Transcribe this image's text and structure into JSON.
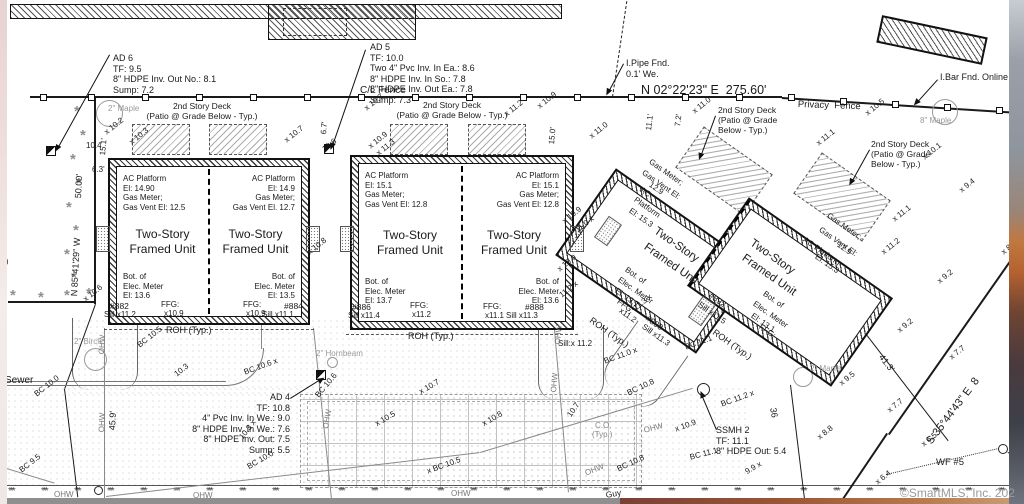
{
  "meta": {
    "watermark": "©SmartMLS, Inc. 202"
  },
  "annotations": {
    "ad6": [
      "AD 6",
      "TF: 9.5",
      "8\" HDPE Inv. Out No.: 8.1",
      "Sump: 7.2"
    ],
    "ad5": [
      "AD 5",
      "TF: 10.0",
      "Two 4\" Pvc Inv. In Ea.: 8.6",
      "8\" HDPE Inv. In So.: 7.8",
      "8\" HDPE Inv. Out Ea.: 7.8",
      "Sump: 7.3"
    ],
    "ad4": [
      "AD 4",
      "TF: 10.8",
      "4\" Pvc Inv. In We.: 9.0",
      "8\" HDPE Inv. In We.: 7.6",
      "8\" HDPE Inv. Out: 7.5",
      "Sump: 5.5"
    ],
    "ssmh2": [
      "SSMH 2",
      "TF: 11.1",
      "8\" HDPE Out: 5.4"
    ],
    "ipipe": [
      "I.Pipe Fnd.",
      "0.1' We."
    ],
    "ibar": [
      "I.Bar Fnd. Online"
    ],
    "deck_ab": [
      "2nd Story Deck",
      "(Patio @ Grade Below - Typ.)"
    ],
    "deck_cd": [
      "2nd Story Deck",
      "(Patio @ Grade",
      "Below - Typ.)"
    ]
  },
  "buildings": {
    "b1u1": {
      "ac": [
        "AC Platform",
        "El: 14.90",
        "Gas Meter;",
        "Gas Vent El: 12.5"
      ],
      "name": [
        "Two-Story",
        "Framed Unit"
      ],
      "elec": [
        "Bot. of",
        "Elec. Meter",
        "El: 13.6"
      ]
    },
    "b1u2": {
      "ac": [
        "AC Platform",
        "El: 14.9",
        "Gas Meter;",
        "Gas Vent El. 12.7"
      ],
      "name": [
        "Two-Story",
        "Framed Unit"
      ],
      "elec": [
        "Bot. of",
        "Elec. Meter",
        "El: 13.5"
      ]
    },
    "b2u1": {
      "ac": [
        "AC Platform",
        "El: 15.1",
        "Gas Meter;",
        "Gas Vent El: 12.8"
      ],
      "name": [
        "Two-Story",
        "Framed Unit"
      ],
      "elec": [
        "Bot. of",
        "Elec. Meter",
        "El: 13.7"
      ]
    },
    "b2u2": {
      "ac": [
        "AC Platform",
        "El: 15.1",
        "Gas Meter;",
        "Gas Vent El: 12.8"
      ],
      "name": [
        "Two-Story",
        "Framed Unit"
      ],
      "elec": [
        "Bot. of",
        "Elec. Meter",
        "El: 13.6"
      ]
    }
  },
  "labels": [
    {
      "t": "N 02°22'23\" E  275.60'",
      "x": 641,
      "y": 84,
      "s": 12.5,
      "n": "bearing-north"
    },
    {
      "t": "C/L Fence",
      "x": 360,
      "y": 86,
      "s": 10,
      "n": "cl-fence-label"
    },
    {
      "t": "Privacy  Fence",
      "x": 798,
      "y": 100,
      "s": 9.5,
      "r": 2,
      "n": "privacy-fence-label"
    },
    {
      "t": "N 85°41'29\" W",
      "x": 70,
      "y": 296,
      "r": -87,
      "s": 9,
      "n": "bearing-west"
    },
    {
      "t": "S 35°44'43\" E  8",
      "x": 925,
      "y": 440,
      "r": -53,
      "s": 11,
      "n": "bearing-southeast"
    },
    {
      "t": "50.00'",
      "x": 74,
      "y": 198,
      "r": -87,
      "s": 9
    },
    {
      "t": "15.1'",
      "x": 99,
      "y": 155,
      "r": -85
    },
    {
      "t": "6.3'",
      "x": 92,
      "y": 166
    },
    {
      "t": "45.9'",
      "x": 108,
      "y": 430,
      "r": -87,
      "s": 9
    },
    {
      "t": "6.7'",
      "x": 320,
      "y": 134,
      "r": -85
    },
    {
      "t": "15.0'",
      "x": 548,
      "y": 144,
      "r": -85
    },
    {
      "t": "11.1'",
      "x": 645,
      "y": 130,
      "r": -83
    },
    {
      "t": "7.2'",
      "x": 674,
      "y": 126,
      "r": -83
    },
    {
      "t": "41.3'",
      "x": 884,
      "y": 353,
      "r": 52,
      "s": 9
    },
    {
      "t": "36",
      "x": 777,
      "y": 407,
      "r": 80,
      "s": 9
    },
    {
      "t": "2\" Maple",
      "x": 108,
      "y": 105,
      "c": "#999",
      "n": "tree-label"
    },
    {
      "t": "8\" Maple",
      "x": 920,
      "y": 117,
      "c": "#999",
      "n": "tree-label"
    },
    {
      "t": "2\" Birch",
      "x": 74,
      "y": 338,
      "c": "#999",
      "n": "tree-label"
    },
    {
      "t": "2\" Hornbeam",
      "x": 316,
      "y": 350,
      "c": "#999",
      "n": "tree-label"
    },
    {
      "t": "2\" Maple",
      "x": 810,
      "y": 365,
      "c": "#999",
      "n": "tree-label"
    },
    {
      "t": "Sewer",
      "x": 5,
      "y": 376,
      "s": 10,
      "n": "sewer-label"
    },
    {
      "t": "Guy",
      "x": 605,
      "y": 491,
      "r": -10,
      "s": 8.5
    },
    {
      "t": "WF #5",
      "x": 936,
      "y": 458,
      "s": 9.5,
      "n": "wetland-flag-label"
    },
    {
      "t": "(Typ.)",
      "x": -12,
      "y": 258
    },
    {
      "t": "C.O.",
      "x": 595,
      "y": 422,
      "c": "#888"
    },
    {
      "t": "(Typ.)",
      "x": 592,
      "y": 431,
      "c": "#888"
    },
    {
      "t": "x 10.2",
      "x": 103,
      "y": 130,
      "r": -38
    },
    {
      "t": "10.4",
      "x": 86,
      "y": 142
    },
    {
      "t": "x 10.3",
      "x": 128,
      "y": 140,
      "r": -38
    },
    {
      "t": "x 10.7",
      "x": 363,
      "y": 106,
      "r": -38
    },
    {
      "t": "x 10.9",
      "x": 536,
      "y": 104,
      "r": -38
    },
    {
      "t": "x 11.2",
      "x": 503,
      "y": 112,
      "r": -38
    },
    {
      "t": "x 10.7",
      "x": 283,
      "y": 138,
      "r": -38
    },
    {
      "t": "10.6",
      "x": 321,
      "y": 147,
      "r": -38
    },
    {
      "t": "x 10.9",
      "x": 367,
      "y": 144,
      "r": -38
    },
    {
      "t": "x 11.3",
      "x": 375,
      "y": 151,
      "r": -38
    },
    {
      "t": "x 10.8",
      "x": 306,
      "y": 250,
      "r": -38
    },
    {
      "t": "x 10.9",
      "x": 561,
      "y": 219,
      "r": -38
    },
    {
      "t": "x 10.9",
      "x": 556,
      "y": 267,
      "r": -38
    },
    {
      "t": "11.2 x",
      "x": 558,
      "y": 293,
      "r": -38
    },
    {
      "t": "11.0 x",
      "x": 574,
      "y": 228,
      "r": -38
    },
    {
      "t": "x 11.0",
      "x": 588,
      "y": 134,
      "r": -38
    },
    {
      "t": "x 11.0",
      "x": 691,
      "y": 109,
      "r": -38
    },
    {
      "t": "x 10.5",
      "x": 864,
      "y": 111,
      "r": -38
    },
    {
      "t": "x 11.1",
      "x": 815,
      "y": 141,
      "r": -38
    },
    {
      "t": "x 10.1",
      "x": 921,
      "y": 155,
      "r": -38
    },
    {
      "t": "x 9.4",
      "x": 958,
      "y": 188,
      "r": -38
    },
    {
      "t": "x 11.1",
      "x": 891,
      "y": 217,
      "r": -38
    },
    {
      "t": "x 11.2",
      "x": 880,
      "y": 250,
      "r": -38
    },
    {
      "t": "x 9.2",
      "x": 936,
      "y": 279,
      "r": -38
    },
    {
      "t": "x 8",
      "x": 1000,
      "y": 250,
      "r": -38
    },
    {
      "t": "x 9.2",
      "x": 896,
      "y": 328,
      "r": -38
    },
    {
      "t": "x 7.7",
      "x": 948,
      "y": 355,
      "r": -38
    },
    {
      "t": "x 7.7",
      "x": 886,
      "y": 408,
      "r": -38
    },
    {
      "t": "x 6.5",
      "x": 920,
      "y": 442,
      "r": -38
    },
    {
      "t": "x 6.4",
      "x": 874,
      "y": 480,
      "r": -38
    },
    {
      "t": "x 8.8",
      "x": 816,
      "y": 435,
      "r": -38
    },
    {
      "t": "9.9 x",
      "x": 744,
      "y": 469,
      "r": -30
    },
    {
      "t": "x 9.5",
      "x": 838,
      "y": 381,
      "r": -38
    },
    {
      "t": "11.3 x",
      "x": 632,
      "y": 306,
      "r": -38
    },
    {
      "t": "x 10.6",
      "x": 82,
      "y": 297,
      "r": -38
    },
    {
      "t": "BC 10.5",
      "x": 136,
      "y": 343,
      "r": -38
    },
    {
      "t": "10.3",
      "x": 173,
      "y": 372,
      "r": -38
    },
    {
      "t": "BC 10.6 x",
      "x": 243,
      "y": 369,
      "r": -20
    },
    {
      "t": "BC 10.6",
      "x": 314,
      "y": 394,
      "r": -50
    },
    {
      "t": "x 10.7",
      "x": 418,
      "y": 389,
      "r": -30
    },
    {
      "t": "x 10.5",
      "x": 374,
      "y": 421,
      "r": -30
    },
    {
      "t": "x 10.8",
      "x": 481,
      "y": 421,
      "r": -30
    },
    {
      "t": "x BC 10.5",
      "x": 426,
      "y": 468,
      "r": -20
    },
    {
      "t": "BC 10.0",
      "x": 33,
      "y": 392,
      "r": -38
    },
    {
      "t": "BC 10.0",
      "x": 246,
      "y": 464,
      "r": -30
    },
    {
      "t": "BC 9.5",
      "x": 18,
      "y": 468,
      "r": -38
    },
    {
      "t": "10.3 x",
      "x": 238,
      "y": 436,
      "r": -52
    },
    {
      "t": "10.7",
      "x": 566,
      "y": 414,
      "r": -55
    },
    {
      "t": "Sill:x 11.2",
      "x": 558,
      "y": 340
    },
    {
      "t": "BC 11.0 x",
      "x": 603,
      "y": 358,
      "r": -20
    },
    {
      "t": "BC 10.8",
      "x": 626,
      "y": 390,
      "r": -25
    },
    {
      "t": "BC 11.1",
      "x": 684,
      "y": 344,
      "r": -20
    },
    {
      "t": "BC 11.2 x",
      "x": 720,
      "y": 401,
      "r": -20
    },
    {
      "t": "x 10.9",
      "x": 674,
      "y": 426,
      "r": -20
    },
    {
      "t": "BC 11.1",
      "x": 689,
      "y": 454,
      "r": -15
    },
    {
      "t": "BC 10.8",
      "x": 616,
      "y": 466,
      "r": -25
    },
    {
      "t": "OHW",
      "x": 98,
      "y": 354,
      "r": -87,
      "c": "#777"
    },
    {
      "t": "OHW",
      "x": 98,
      "y": 432,
      "r": -87,
      "c": "#777"
    },
    {
      "t": "OHW",
      "x": 322,
      "y": 428,
      "r": -80,
      "c": "#777"
    },
    {
      "t": "OHW",
      "x": 554,
      "y": 344,
      "r": -85,
      "c": "#777"
    },
    {
      "t": "OHW",
      "x": 550,
      "y": 392,
      "r": -85,
      "c": "#777"
    },
    {
      "t": "OHW",
      "x": 643,
      "y": 427,
      "r": -15,
      "c": "#777"
    },
    {
      "t": "OHW",
      "x": 584,
      "y": 470,
      "r": -22,
      "c": "#777"
    },
    {
      "t": "OHW",
      "x": 54,
      "y": 491,
      "c": "#777"
    },
    {
      "t": "OHW",
      "x": 193,
      "y": 492,
      "c": "#777"
    },
    {
      "t": "OHW",
      "x": 451,
      "y": 490,
      "c": "#777"
    },
    {
      "t": "#882",
      "x": 110,
      "y": 302,
      "s": 8.5,
      "n": "unit-number"
    },
    {
      "t": "Sill x11.2",
      "x": 104,
      "y": 311
    },
    {
      "t": "FFG:",
      "x": 161,
      "y": 301
    },
    {
      "t": "x10.9",
      "x": 164,
      "y": 310
    },
    {
      "t": "FFG:",
      "x": 243,
      "y": 301
    },
    {
      "t": "x10.9",
      "x": 246,
      "y": 310
    },
    {
      "t": "#884",
      "x": 284,
      "y": 302,
      "s": 8.5,
      "n": "unit-number"
    },
    {
      "t": "Sill x11.1",
      "x": 262,
      "y": 311
    },
    {
      "t": "ROH (Typ.)",
      "x": 166,
      "y": 326,
      "s": 9
    },
    {
      "t": "#886",
      "x": 352,
      "y": 303,
      "s": 8.5,
      "n": "unit-number"
    },
    {
      "t": "Sill x11.4",
      "x": 348,
      "y": 312
    },
    {
      "t": "FFG:",
      "x": 410,
      "y": 302
    },
    {
      "t": "x11.2",
      "x": 412,
      "y": 311
    },
    {
      "t": "FFG:",
      "x": 483,
      "y": 303
    },
    {
      "t": "x11.1",
      "x": 485,
      "y": 312
    },
    {
      "t": "#888",
      "x": 525,
      "y": 303,
      "s": 8.5,
      "n": "unit-number"
    },
    {
      "t": "Sill x11.3",
      "x": 506,
      "y": 312
    },
    {
      "t": "ROH (Typ.)",
      "x": 408,
      "y": 332,
      "s": 9
    },
    {
      "t": "FFG:",
      "x": 620,
      "y": 298,
      "r": 35
    },
    {
      "t": "x11.2",
      "x": 622,
      "y": 307,
      "r": 35
    },
    {
      "t": "#890",
      "x": 649,
      "y": 314,
      "r": 35,
      "s": 8.5,
      "n": "unit-number"
    },
    {
      "t": "Sill x11.3",
      "x": 645,
      "y": 323,
      "r": 35
    },
    {
      "t": "#892",
      "x": 712,
      "y": 291,
      "r": 35,
      "s": 8.5,
      "n": "unit-number"
    },
    {
      "t": "Sill x11.5",
      "x": 701,
      "y": 301,
      "r": 35
    },
    {
      "t": "ROH (Typ.)",
      "x": 593,
      "y": 316,
      "r": 35,
      "s": 9
    },
    {
      "t": "ROH (Typ.)",
      "x": 716,
      "y": 328,
      "r": 35,
      "s": 9
    },
    {
      "t": "FFG:",
      "x": 762,
      "y": 323,
      "r": 35
    },
    {
      "t": "Gas Meter;",
      "x": 652,
      "y": 158,
      "r": 35
    },
    {
      "t": "Gas Vent El:",
      "x": 645,
      "y": 169,
      "r": 35
    },
    {
      "t": "12.9",
      "x": 652,
      "y": 181,
      "r": 35
    },
    {
      "t": "AC",
      "x": 643,
      "y": 186,
      "r": 35
    },
    {
      "t": "Platform",
      "x": 637,
      "y": 196,
      "r": 35
    },
    {
      "t": "El: 15.3",
      "x": 632,
      "y": 207,
      "r": 35
    },
    {
      "t": "Two-Story",
      "x": 658,
      "y": 226,
      "r": 35,
      "s": 11.5,
      "n": "unit-name"
    },
    {
      "t": "Framed Unit",
      "x": 648,
      "y": 242,
      "r": 35,
      "s": 11.5,
      "n": "unit-name"
    },
    {
      "t": "Bot. of",
      "x": 628,
      "y": 266,
      "r": 35
    },
    {
      "t": "Elec. Meter",
      "x": 621,
      "y": 276,
      "r": 35
    },
    {
      "t": "El: 13.7",
      "x": 618,
      "y": 287,
      "r": 35
    },
    {
      "t": "Gas Meter;",
      "x": 830,
      "y": 212,
      "r": 35
    },
    {
      "t": "Gas Vent El:",
      "x": 822,
      "y": 226,
      "r": 35
    },
    {
      "t": "12.9",
      "x": 840,
      "y": 241,
      "r": 35
    },
    {
      "t": "AC Platform",
      "x": 806,
      "y": 236,
      "r": 35
    },
    {
      "t": "El: 15.3",
      "x": 818,
      "y": 253,
      "r": 35
    },
    {
      "t": "Two-Story",
      "x": 754,
      "y": 238,
      "r": 35,
      "s": 11.5,
      "n": "unit-name"
    },
    {
      "t": "Framed Unit",
      "x": 746,
      "y": 253,
      "r": 35,
      "s": 11.5,
      "n": "unit-name"
    },
    {
      "t": "Bot. of",
      "x": 766,
      "y": 290,
      "r": 35
    },
    {
      "t": "Elec. Meter",
      "x": 756,
      "y": 300,
      "r": 35
    },
    {
      "t": "El: 13.1",
      "x": 754,
      "y": 312,
      "r": 35
    }
  ]
}
